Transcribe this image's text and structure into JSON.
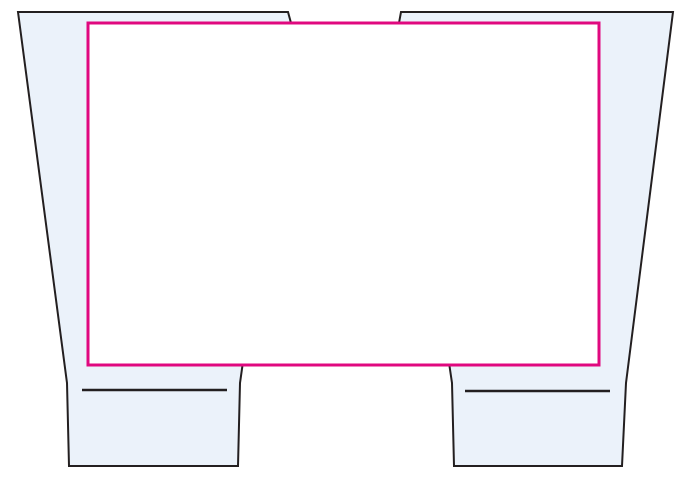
{
  "canvas": {
    "width": 692,
    "height": 484,
    "background": "#FFFFFF"
  },
  "colors": {
    "piece_fill": "#EBF2FA",
    "piece_outline": "#231F20",
    "overlay_rect_stroke": "#E0087F",
    "overlay_rect_fill": "#FFFFFF"
  },
  "strokes": {
    "piece_outline_width": 2,
    "overlay_rect_width": 3,
    "fold_line_width": 2.4
  },
  "pieces": {
    "left": {
      "outline_points": "18,12 288,12 291,23 240,383 238,466 69,466 67,383",
      "fold_line_d": "M82,390 L227,390"
    },
    "right": {
      "outline_points": "401,12 673,12 626,383 622,466 454,466 452,383 399,23",
      "fold_line_d": "M465,391 L610,391"
    }
  },
  "overlay_rect": {
    "x": 88,
    "y": 23,
    "width": 511,
    "height": 342
  }
}
